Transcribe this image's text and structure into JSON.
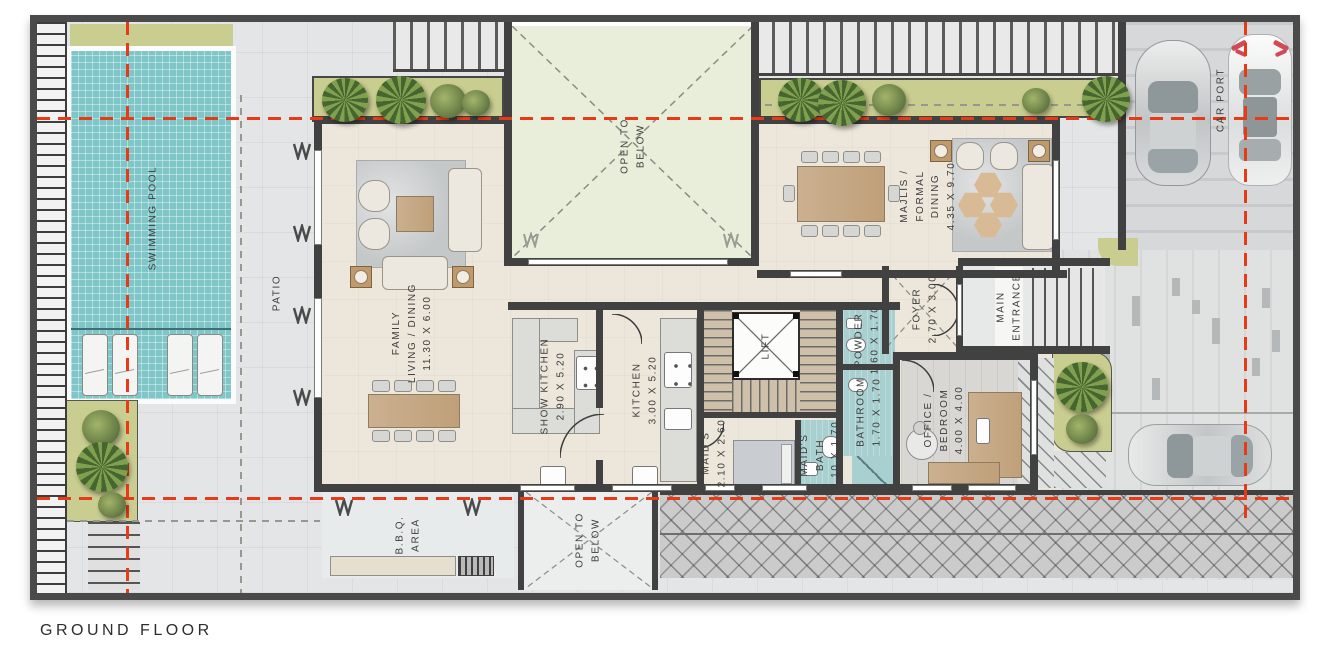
{
  "caption": "GROUND FLOOR",
  "colors": {
    "accent_red": "#e73b17",
    "wall": "#414141",
    "pool": "#7fc6c9",
    "planter_olive": "#c9cd90",
    "courtyard_green": "#e9eedb",
    "floor_cream": "#ece6db",
    "floor_paving": "#e3e5e6",
    "bath_teal": "#a9d0d1",
    "deck_gray": "#cbcbcb"
  },
  "icons": {
    "palm-tree-icon": "circle-conic-fronds",
    "bush-icon": "radial-green-circle",
    "column-marker-icon": "zigzag-W",
    "car-top-view-icon": "rounded-rect-car",
    "lift-cross-icon": "x-lines",
    "open-void-icon": "dashed-x"
  },
  "rooms": {
    "swimming_pool": {
      "label": "SWIMMING POOL"
    },
    "patio": {
      "label": "PATIO"
    },
    "family_living_dining": {
      "label": "FAMILY\nLIVING / DINING\n11.30 X 6.00"
    },
    "courtyard": {
      "label": "OPEN TO\nBELOW"
    },
    "majlis_formal_dining": {
      "label": "MAJLIS /\nFORMAL\nDINING\n4.35 X 9.70"
    },
    "foyer": {
      "label": "FOYER\n2.70 X 3.00"
    },
    "main_entrance": {
      "label": "MAIN\nENTRANCE"
    },
    "car_port": {
      "label": "CAR PORT"
    },
    "show_kitchen": {
      "label": "SHOW KITCHEN\n2.90 X 5.20"
    },
    "kitchen": {
      "label": "KITCHEN\n3.00 X 5.20"
    },
    "lift": {
      "label": "LIFT"
    },
    "powder": {
      "label": "POWDER\n1.60 X 1.70"
    },
    "bathroom": {
      "label": "BATHROOM\n1.70 X 1.70"
    },
    "maids": {
      "label": "MAID'S\n2.10 X 2.60"
    },
    "maids_bath": {
      "label": "MAID'S\nBATH\n2.10 X 1.70"
    },
    "office_bedroom": {
      "label": "OFFICE /\nBEDROOM\n4.00 X 4.00"
    },
    "bbq": {
      "label": "B.B.Q.\nAREA"
    },
    "open_to_below_rear": {
      "label": "OPEN TO\nBELOW"
    }
  }
}
